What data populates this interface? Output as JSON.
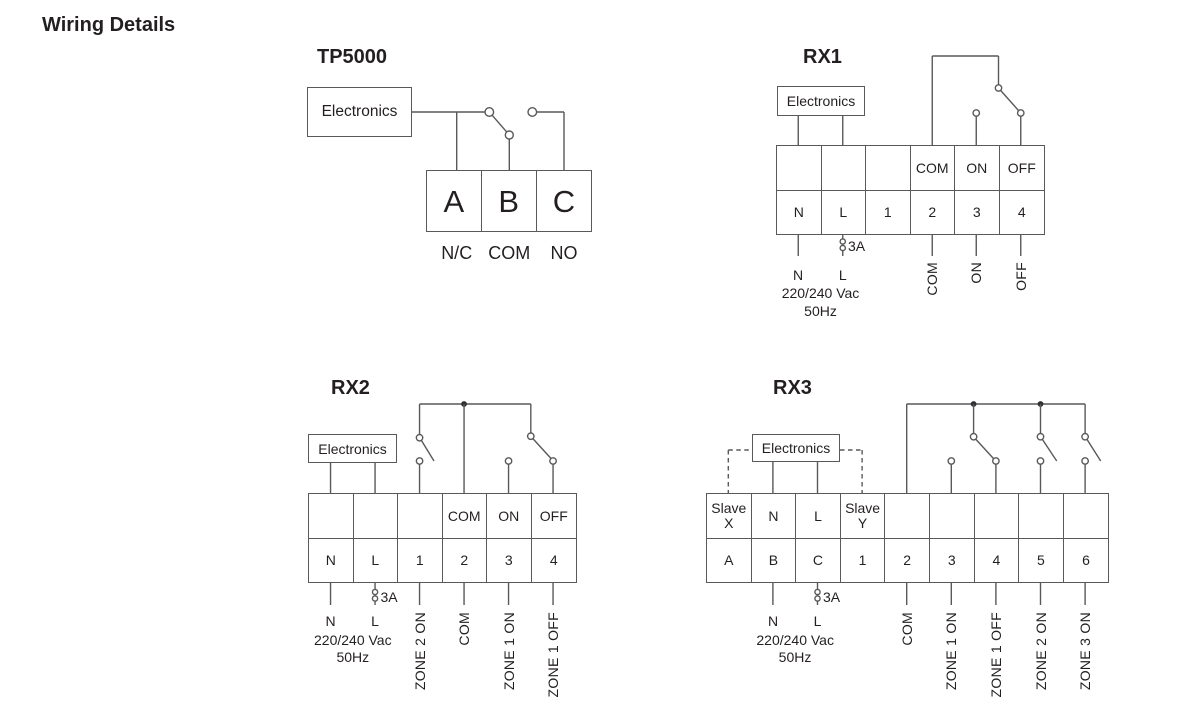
{
  "page": {
    "heading": "Wiring Details"
  },
  "colors": {
    "line": "#58595b",
    "text": "#231f20"
  },
  "tp5000": {
    "title": "TP5000",
    "electronics_label": "Electronics",
    "terminals": [
      "A",
      "B",
      "C"
    ],
    "terminal_labels": [
      "N/C",
      "COM",
      "NO"
    ]
  },
  "rx1": {
    "title": "RX1",
    "electronics_label": "Electronics",
    "grid": {
      "top_row": [
        "",
        "",
        "",
        "COM",
        "ON",
        "OFF"
      ],
      "bottom_row": [
        "N",
        "L",
        "1",
        "2",
        "3",
        "4"
      ]
    },
    "fuse_label": "3A",
    "supply": {
      "neutral": "N",
      "live": "L",
      "voltage": "220/240 Vac",
      "frequency": "50Hz"
    },
    "outputs": [
      "COM",
      "ON",
      "OFF"
    ]
  },
  "rx2": {
    "title": "RX2",
    "electronics_label": "Electronics",
    "grid": {
      "top_row": [
        "",
        "",
        "",
        "COM",
        "ON",
        "OFF"
      ],
      "bottom_row": [
        "N",
        "L",
        "1",
        "2",
        "3",
        "4"
      ]
    },
    "fuse_label": "3A",
    "supply": {
      "neutral": "N",
      "live": "L",
      "voltage": "220/240 Vac",
      "frequency": "50Hz"
    },
    "outputs": [
      "ZONE 2 ON",
      "COM",
      "ZONE 1 ON",
      "ZONE 1 OFF"
    ]
  },
  "rx3": {
    "title": "RX3",
    "electronics_label": "Electronics",
    "grid": {
      "top_row": [
        "Slave\nX",
        "N",
        "L",
        "Slave\nY",
        "",
        "",
        "",
        "",
        ""
      ],
      "bottom_row": [
        "A",
        "B",
        "C",
        "1",
        "2",
        "3",
        "4",
        "5",
        "6"
      ]
    },
    "fuse_label": "3A",
    "supply": {
      "neutral": "N",
      "live": "L",
      "voltage": "220/240 Vac",
      "frequency": "50Hz"
    },
    "outputs": [
      "COM",
      "ZONE 1 ON",
      "ZONE 1 OFF",
      "ZONE 2 ON",
      "ZONE 3 ON"
    ]
  }
}
